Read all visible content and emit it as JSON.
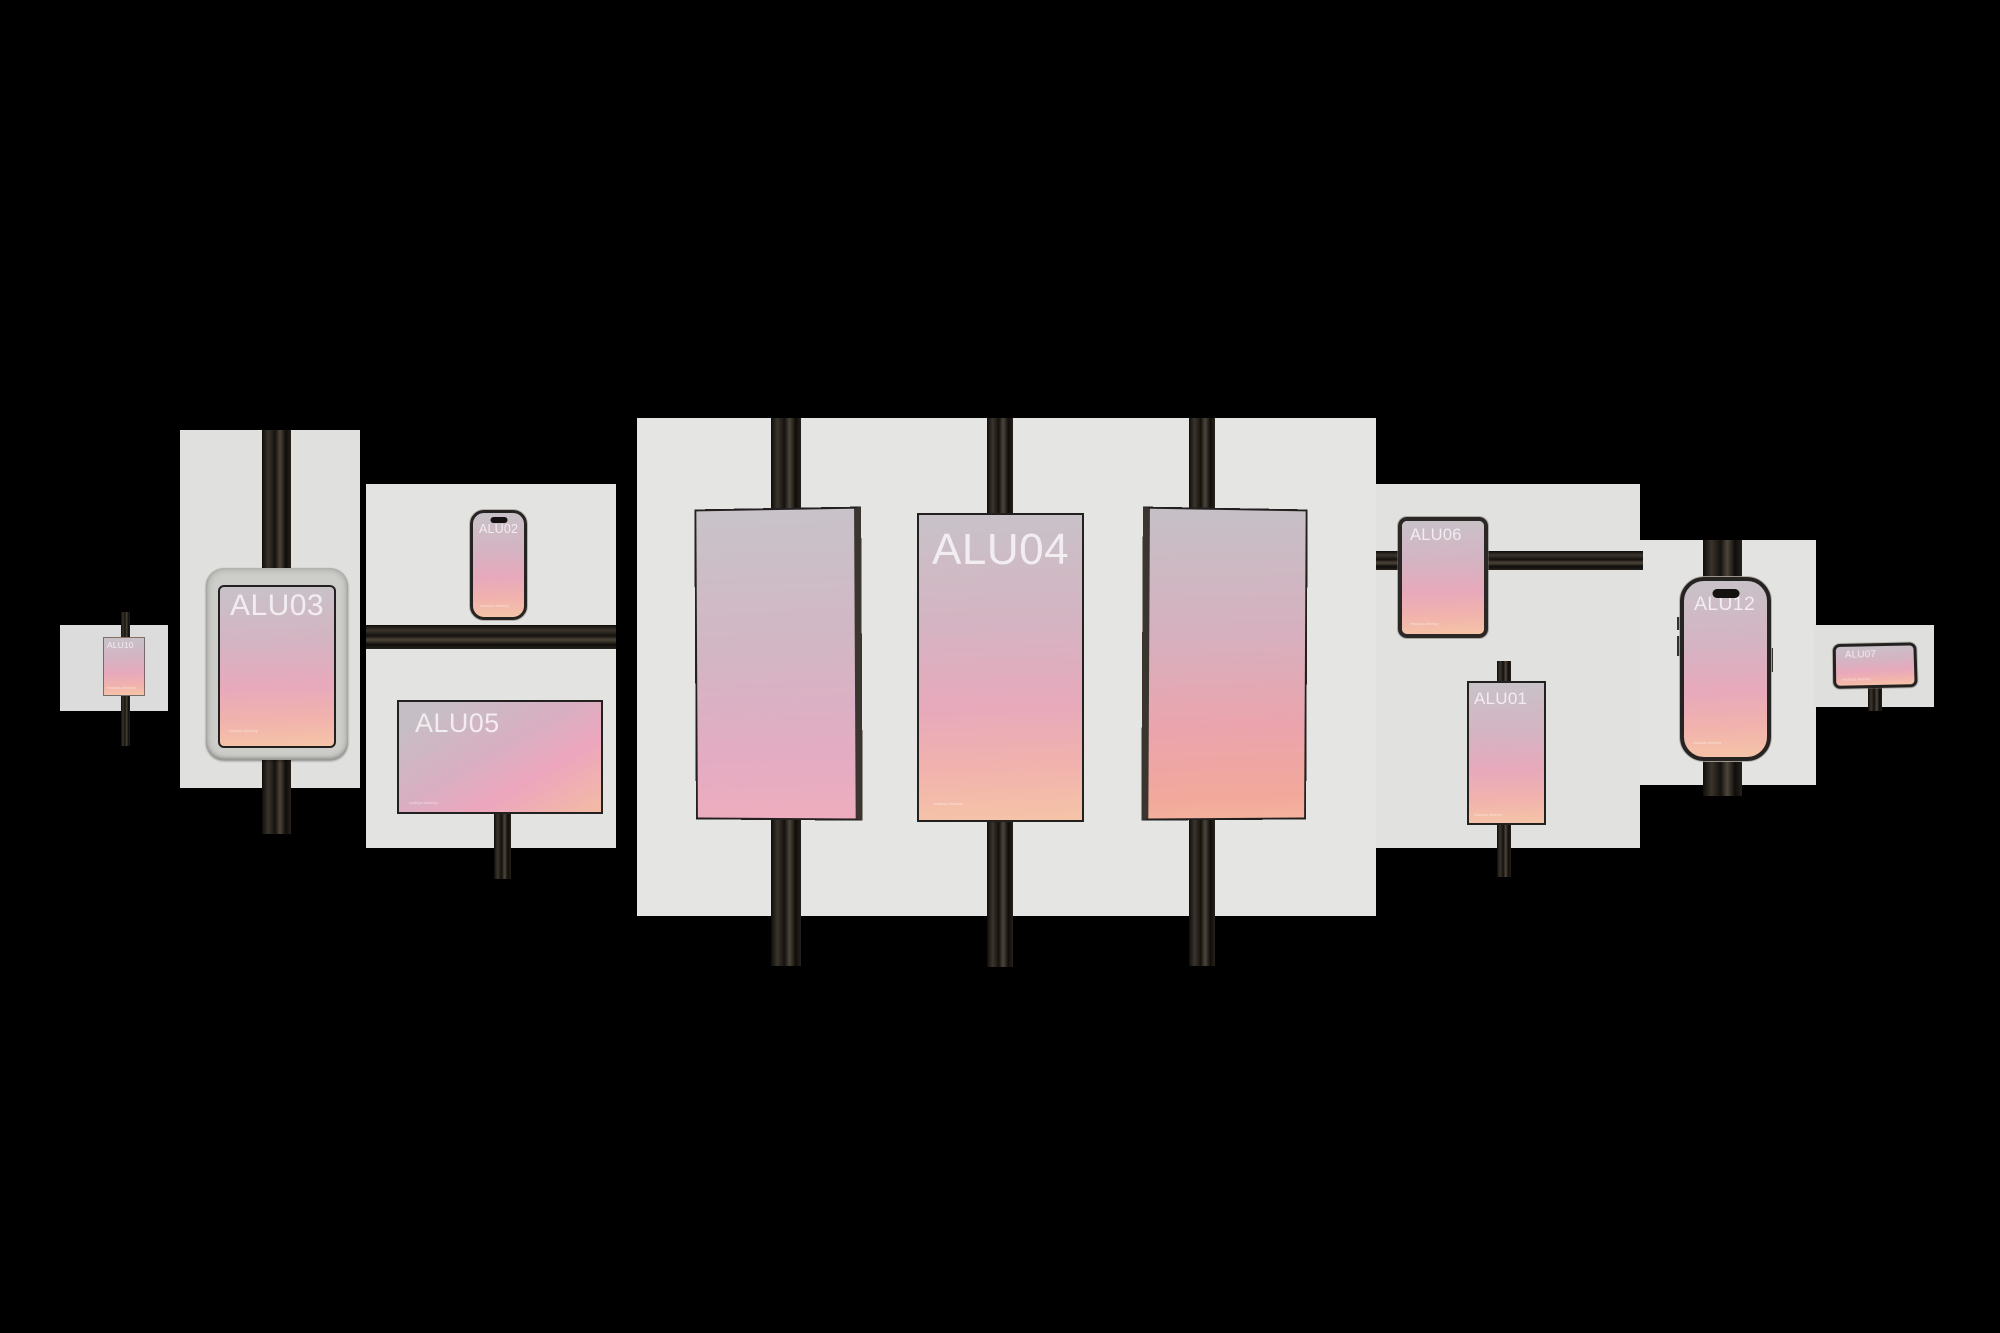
{
  "scene": {
    "background_color": "#000000",
    "panel_color": "#e3e3e2",
    "rail_color": "#1c1916",
    "label_color": "#f5f1f3",
    "screen_gradient_top": "#c8c2c8",
    "screen_gradient_mid": "#e7a9bc",
    "screen_gradient_bottom": "#f5c4a7"
  },
  "devices": [
    {
      "id": "alu10",
      "type": "mini-display",
      "label": "ALU10",
      "caption": "mockups directory"
    },
    {
      "id": "alu03",
      "type": "tablet-in-case",
      "label": "ALU03",
      "caption": "mockups directory"
    },
    {
      "id": "alu02",
      "type": "phone",
      "label": "ALU02",
      "caption": "mockups directory"
    },
    {
      "id": "alu05",
      "type": "landscape-display",
      "label": "ALU05",
      "caption": "mockups directory"
    },
    {
      "id": "display-left",
      "type": "tilted-display",
      "label": "",
      "caption": ""
    },
    {
      "id": "alu04",
      "type": "portrait-display",
      "label": "ALU04",
      "caption": "mockups directory"
    },
    {
      "id": "display-right",
      "type": "tilted-display",
      "label": "",
      "caption": ""
    },
    {
      "id": "alu06",
      "type": "tablet",
      "label": "ALU06",
      "caption": "mockups directory"
    },
    {
      "id": "alu01",
      "type": "flat-display",
      "label": "ALU01",
      "caption": "mockups directory"
    },
    {
      "id": "alu12",
      "type": "phone",
      "label": "ALU12",
      "caption": "mockups directory"
    },
    {
      "id": "alu07",
      "type": "kiosk-display",
      "label": "ALU07",
      "caption": "mockups directory"
    }
  ]
}
